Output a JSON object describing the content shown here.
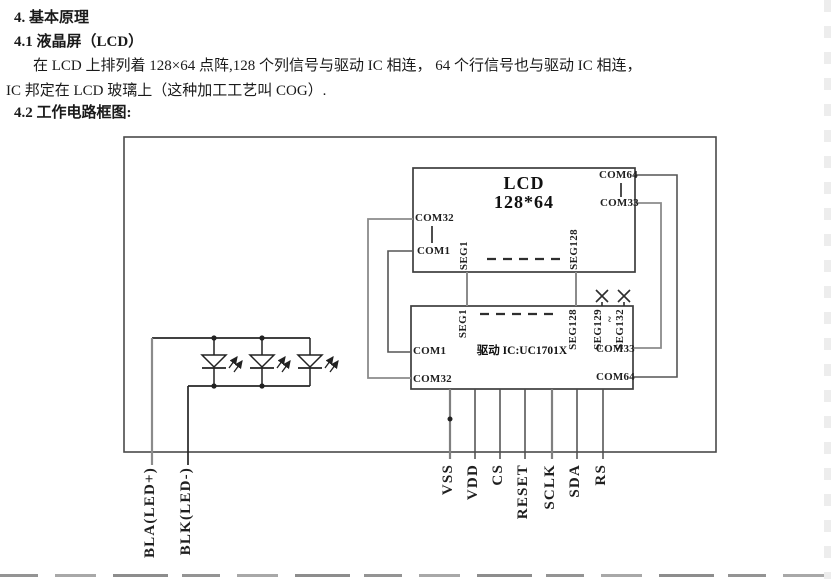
{
  "document": {
    "heading_main": "4. 基本原理",
    "heading_sub": "4.1 液晶屏（LCD）",
    "body_line1": "在 LCD 上排列着 128×64 点阵,128 个列信号与驱动 IC 相连， 64 个行信号也与驱动 IC 相连，",
    "body_line2": "IC 邦定在 LCD 玻璃上（这种加工工艺叫 COG）.",
    "heading_diagram": "4.2 工作电路框图:"
  },
  "diagram": {
    "lcd": {
      "title": "LCD",
      "resolution": "128*64",
      "pin_com32": "COM32",
      "pin_com1": "COM1",
      "pin_com64": "COM64",
      "pin_com33": "COM33",
      "pin_seg1": "SEG1",
      "pin_seg128": "SEG128"
    },
    "driver": {
      "title": "驱动 IC:UC1701X",
      "pin_seg1": "SEG1",
      "pin_seg128": "SEG128",
      "pin_seg129": "SEG129",
      "range_tilde": "~",
      "pin_seg132": "SEG132",
      "pin_com1": "COM1",
      "pin_com32": "COM32",
      "pin_com33": "COM33",
      "pin_com64": "COM64"
    },
    "interface_pins": [
      "VSS",
      "VDD",
      "CS",
      "RESET",
      "SCLK",
      "SDA",
      "RS"
    ],
    "backlight_pins": [
      "BLA(LED+)",
      "BLK(LED-)"
    ],
    "colors": {
      "wire_gray": "#8b8b8b",
      "wire_dark": "#262626",
      "box_border": "#3d3d3d",
      "text": "#1a1a1a"
    }
  }
}
